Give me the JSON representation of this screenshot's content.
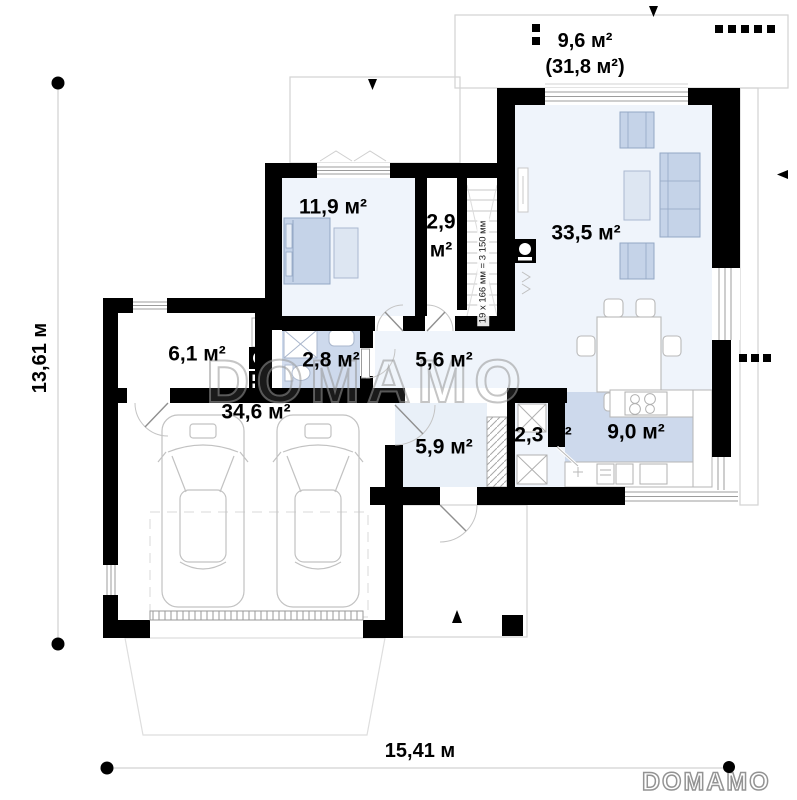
{
  "brand": {
    "watermark": "DOMAMO",
    "logo": "DOMAMO"
  },
  "dimensions": {
    "height_label": "13,61 м",
    "width_label": "15,41 м"
  },
  "terrace": {
    "area": "9,6 м²",
    "area_total": "(31,8 м²)"
  },
  "stairs": {
    "note": "19 x 166 мм = 3 150 мм"
  },
  "rooms": {
    "bedroom": {
      "area": "11,9 м²"
    },
    "closet": {
      "area_value": "2,9",
      "area_unit": "м²"
    },
    "living": {
      "area": "33,5 м²"
    },
    "utility": {
      "area": "6,1 м²"
    },
    "bathroom": {
      "area": "2,8 м²"
    },
    "hall": {
      "area": "5,6 м²"
    },
    "garage": {
      "area": "34,6 м²"
    },
    "vestibule": {
      "area": "5,9 м²"
    },
    "storage": {
      "area": "2,3 м²"
    },
    "kitchen": {
      "area": "9,0 м²"
    }
  },
  "colors": {
    "wall": "#000000",
    "room_floor": "#eff4fb",
    "wet_floor": "#cdd9ec",
    "furniture": "#c5d3e8",
    "outline": "#d3d3d3"
  }
}
